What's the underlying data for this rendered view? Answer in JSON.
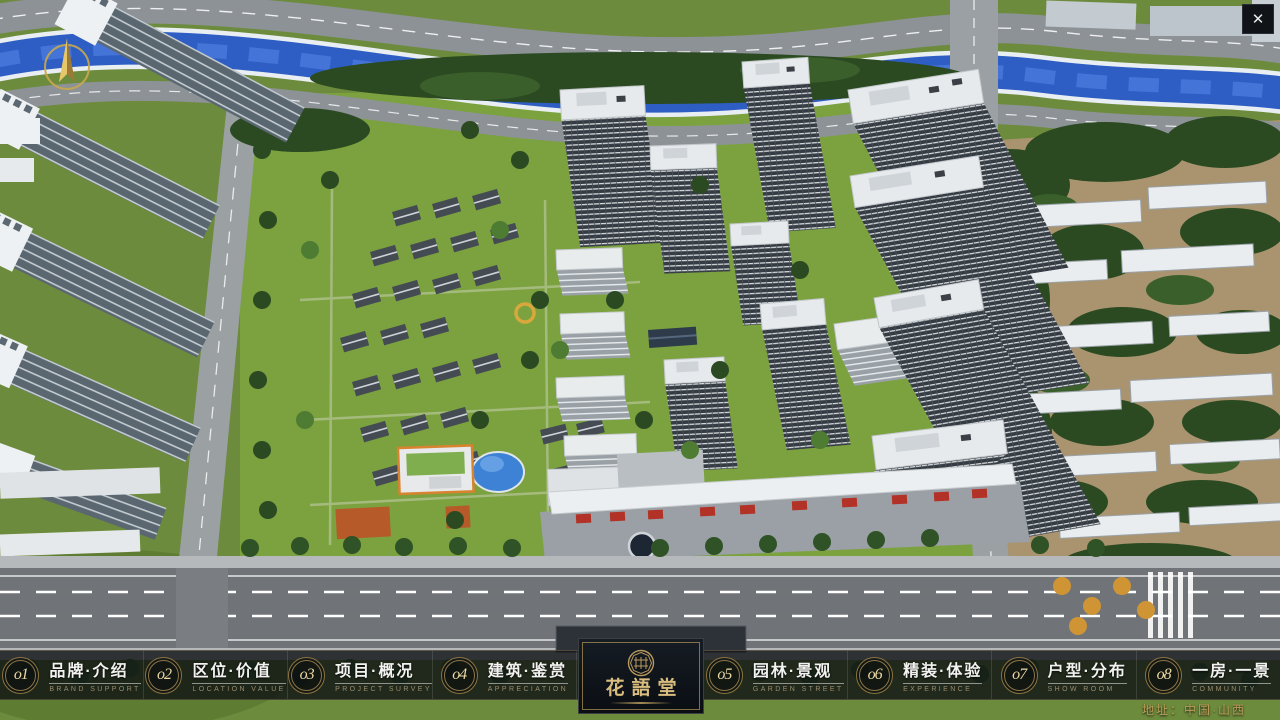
{
  "window": {
    "close_icon": "✕"
  },
  "nav": {
    "items": [
      {
        "num": "o1",
        "zh": "品牌·介绍",
        "en": "BRAND SUPPORT"
      },
      {
        "num": "o2",
        "zh": "区位·价值",
        "en": "LOCATION VALUE"
      },
      {
        "num": "o3",
        "zh": "项目·概况",
        "en": "PROJECT SURVEY"
      },
      {
        "num": "o4",
        "zh": "建筑·鉴赏",
        "en": "APPRECIATION"
      },
      {
        "num": "o5",
        "zh": "园林·景观",
        "en": "GARDEN STREET"
      },
      {
        "num": "o6",
        "zh": "精装·体验",
        "en": "EXPERIENCE"
      },
      {
        "num": "o7",
        "zh": "户型·分布",
        "en": "SHOW ROOM"
      },
      {
        "num": "o8",
        "zh": "一房·一景",
        "en": "COMMUNITY"
      }
    ]
  },
  "logo": {
    "name": "花語堂"
  },
  "footer": {
    "address": "地址：中国·山西"
  },
  "colors": {
    "gold": "#c9a85f",
    "river": "#2e5ec4",
    "grass": "#6d8b3c"
  }
}
